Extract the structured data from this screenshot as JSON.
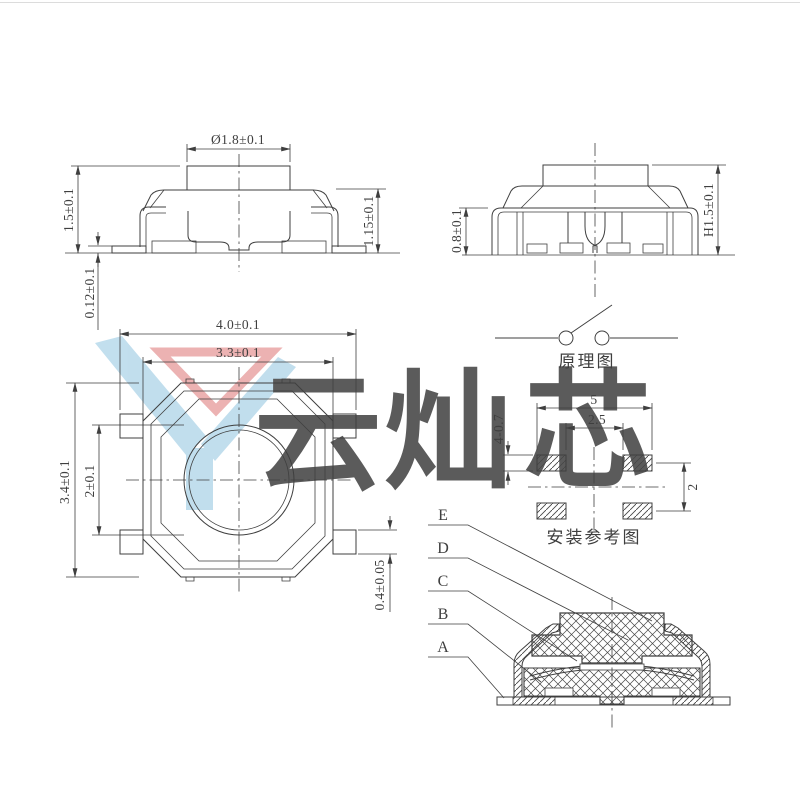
{
  "page": {
    "background": "#ffffff",
    "line_color": "#3f3f3f"
  },
  "front_view": {
    "dim_stem_diameter": "Ø1.8±0.1",
    "dim_total_height": "1.5±0.1",
    "dim_standoff": "0.12±0.1",
    "dim_body_height": "1.15±0.1"
  },
  "side_view": {
    "dim_frame_height": "0.8±0.1",
    "dim_total_height": "H1.5±0.1"
  },
  "top_view": {
    "dim_overall_width": "4.0±0.1",
    "dim_body_width": "3.3±0.1",
    "dim_overall_height": "3.4±0.1",
    "dim_button_diameter": "2±0.1",
    "dim_pin_width": "0.4±0.05"
  },
  "schematic": {
    "caption": "原理图"
  },
  "mounting": {
    "caption": "安装参考图",
    "dim_pad_outer_span": "5",
    "dim_pad_inner_span": "2.5",
    "dim_pad_height": "4-0.7",
    "dim_row_pitch": "2"
  },
  "section_view": {
    "part_labels": [
      "E",
      "D",
      "C",
      "B",
      "A"
    ]
  },
  "watermark": {
    "char_1": "云",
    "char_2": "灿",
    "char_3": "芯",
    "blue": "#a6cfe7",
    "red": "#eaa6a6"
  }
}
